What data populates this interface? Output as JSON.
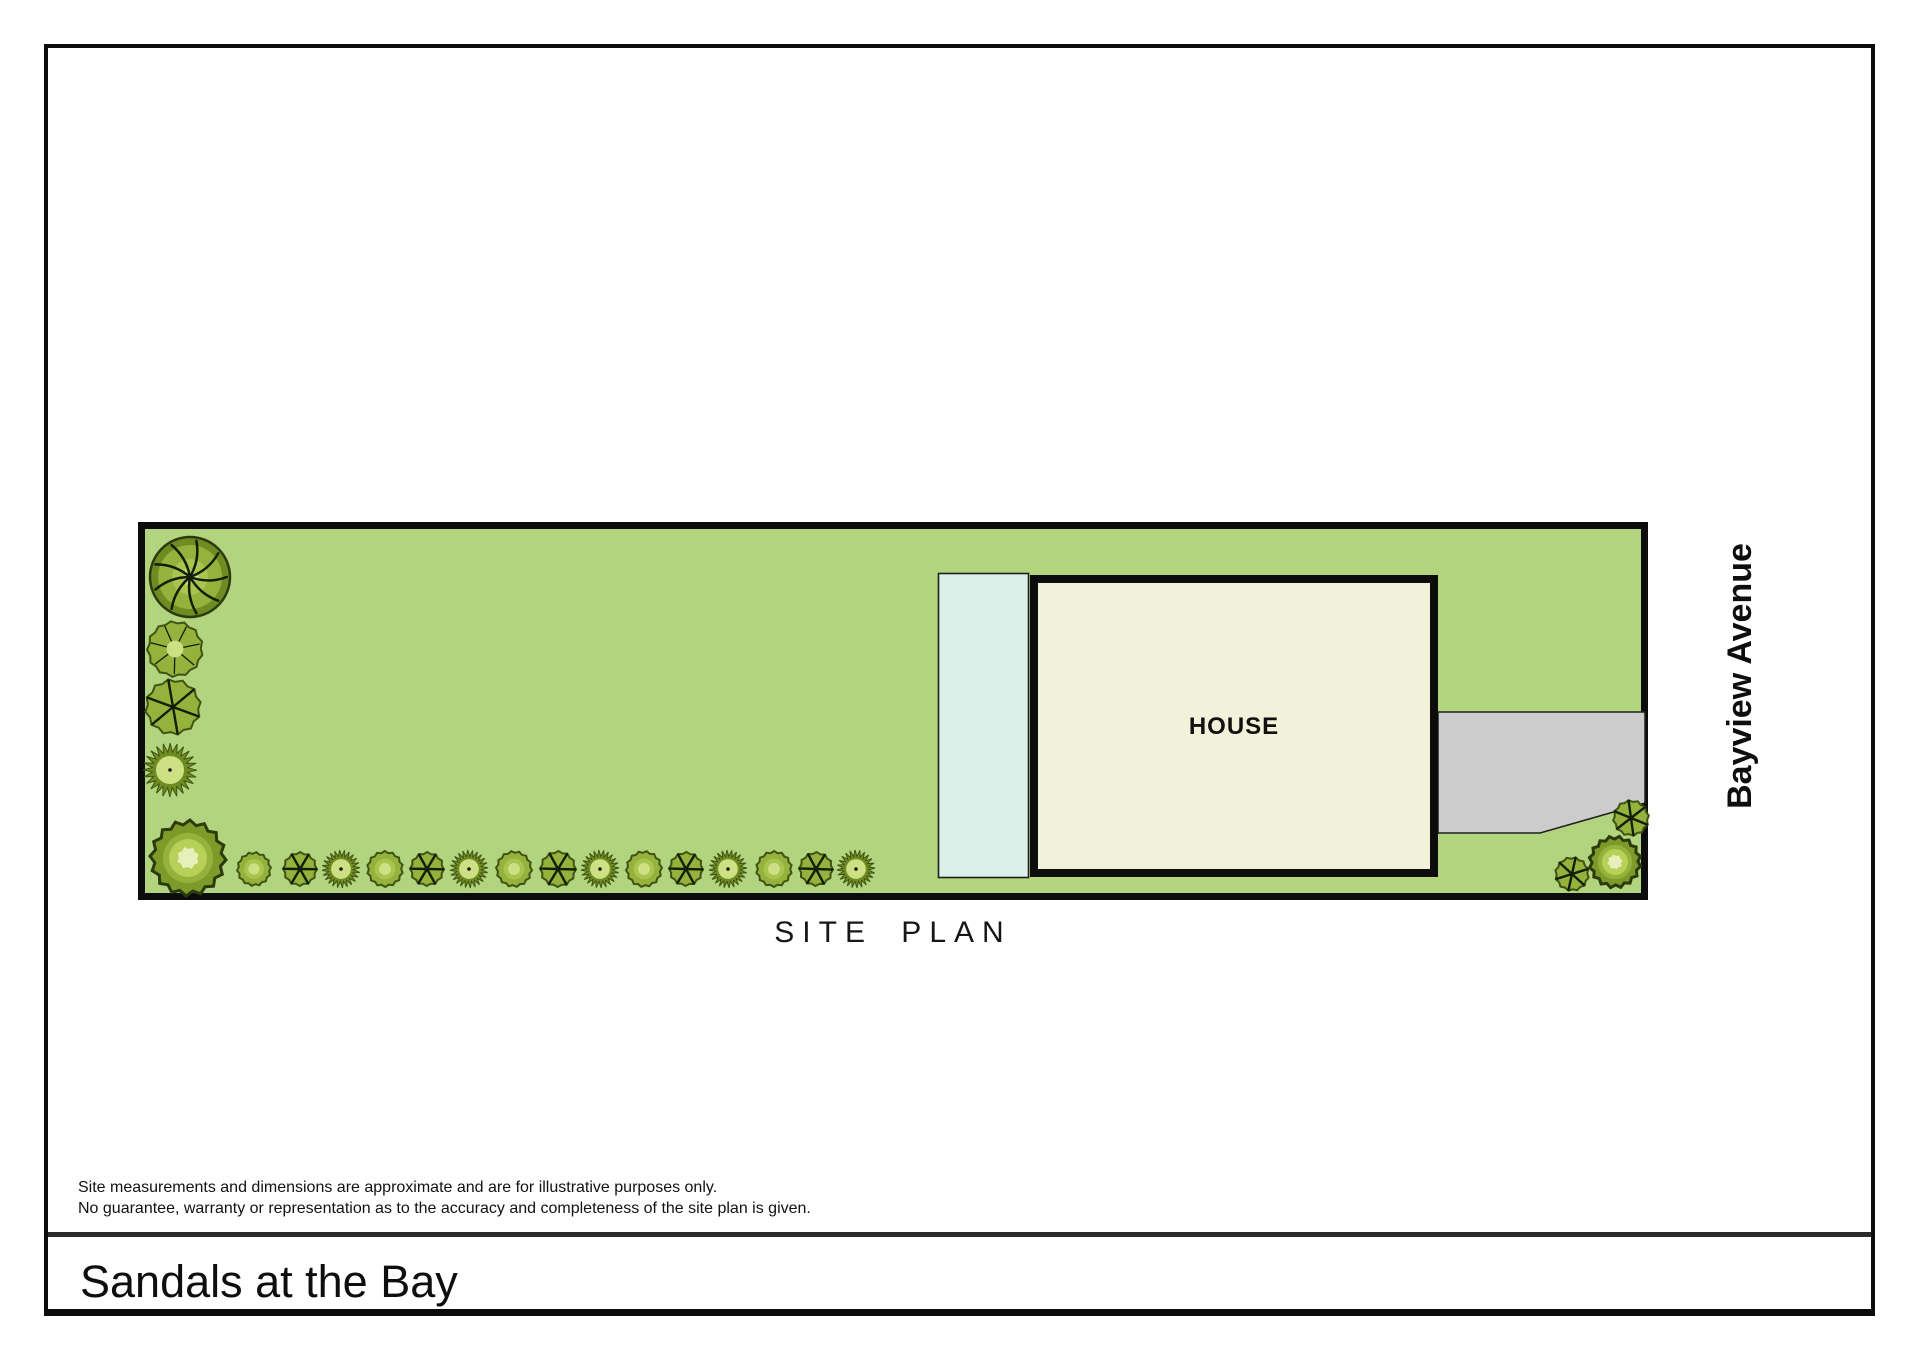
{
  "document": {
    "title": "Sandals at the Bay",
    "plan_caption": "SITE PLAN",
    "street_label": "Bayview Avenue",
    "disclaimer_line1": "Site measurements and dimensions are approximate and are for illustrative purposes only.",
    "disclaimer_line2": "No guarantee, warranty or representation as to the accuracy and completeness of the site plan is given."
  },
  "colors": {
    "grass": "#b2d47e",
    "pool": "#ddefe9",
    "house": "#f1f2d9",
    "driveway": "#cbcccb",
    "outline": "#0c0c0c",
    "thin_outline": "#1f1f1f",
    "tree_edge": "#3f5413",
    "tree_dark": "#6f8c22",
    "tree_mid": "#94b23c",
    "tree_mid2": "#a9c44f",
    "tree_light": "#cde083",
    "tree_pale": "#e7efbb",
    "branch": "#141d05",
    "bush_body": "#7e9b2a",
    "bush_edge": "#2c3b0d"
  },
  "site": {
    "width": 1510,
    "height": 378,
    "border": 7,
    "house_label": "HOUSE",
    "pool": {
      "x": 800.5,
      "y": 51.5,
      "w": 90,
      "h": 304
    },
    "house": {
      "x": 896,
      "y": 57,
      "w": 400,
      "h": 294,
      "border": 8,
      "label_x": 1096,
      "label_y": 212
    },
    "driveway_points": "1300,190 1507,190 1507,281 1402,311 1300,311",
    "trees": [
      {
        "type": "branchy",
        "x": 52,
        "y": 55,
        "r": 40
      },
      {
        "type": "fern",
        "x": 37,
        "y": 127,
        "r": 28
      },
      {
        "type": "spoked",
        "x": 35,
        "y": 185,
        "r": 28
      },
      {
        "type": "spiky",
        "x": 32,
        "y": 248,
        "r": 27
      },
      {
        "type": "bigbush",
        "x": 50,
        "y": 336,
        "r": 38
      },
      {
        "type": "plain",
        "x": 116,
        "y": 347,
        "r": 17
      },
      {
        "type": "spoked",
        "x": 162,
        "y": 347,
        "r": 17
      },
      {
        "type": "spiky",
        "x": 203,
        "y": 347,
        "r": 19
      },
      {
        "type": "plain",
        "x": 247,
        "y": 347,
        "r": 18
      },
      {
        "type": "spoked",
        "x": 289,
        "y": 347,
        "r": 17
      },
      {
        "type": "spiky",
        "x": 331,
        "y": 347,
        "r": 19
      },
      {
        "type": "plain",
        "x": 376,
        "y": 347,
        "r": 18
      },
      {
        "type": "spoked",
        "x": 420,
        "y": 347,
        "r": 18
      },
      {
        "type": "spiky",
        "x": 462,
        "y": 347,
        "r": 19
      },
      {
        "type": "plain",
        "x": 506,
        "y": 347,
        "r": 18
      },
      {
        "type": "spoked",
        "x": 548,
        "y": 347,
        "r": 17
      },
      {
        "type": "spiky",
        "x": 590,
        "y": 347,
        "r": 19
      },
      {
        "type": "plain",
        "x": 636,
        "y": 347,
        "r": 18
      },
      {
        "type": "spoked",
        "x": 678,
        "y": 347,
        "r": 17
      },
      {
        "type": "spiky",
        "x": 718,
        "y": 347,
        "r": 19
      },
      {
        "type": "spoked",
        "x": 1493,
        "y": 296,
        "r": 18
      },
      {
        "type": "bigbush",
        "x": 1477,
        "y": 340,
        "r": 26
      },
      {
        "type": "spoked",
        "x": 1434,
        "y": 352,
        "r": 17
      }
    ]
  }
}
